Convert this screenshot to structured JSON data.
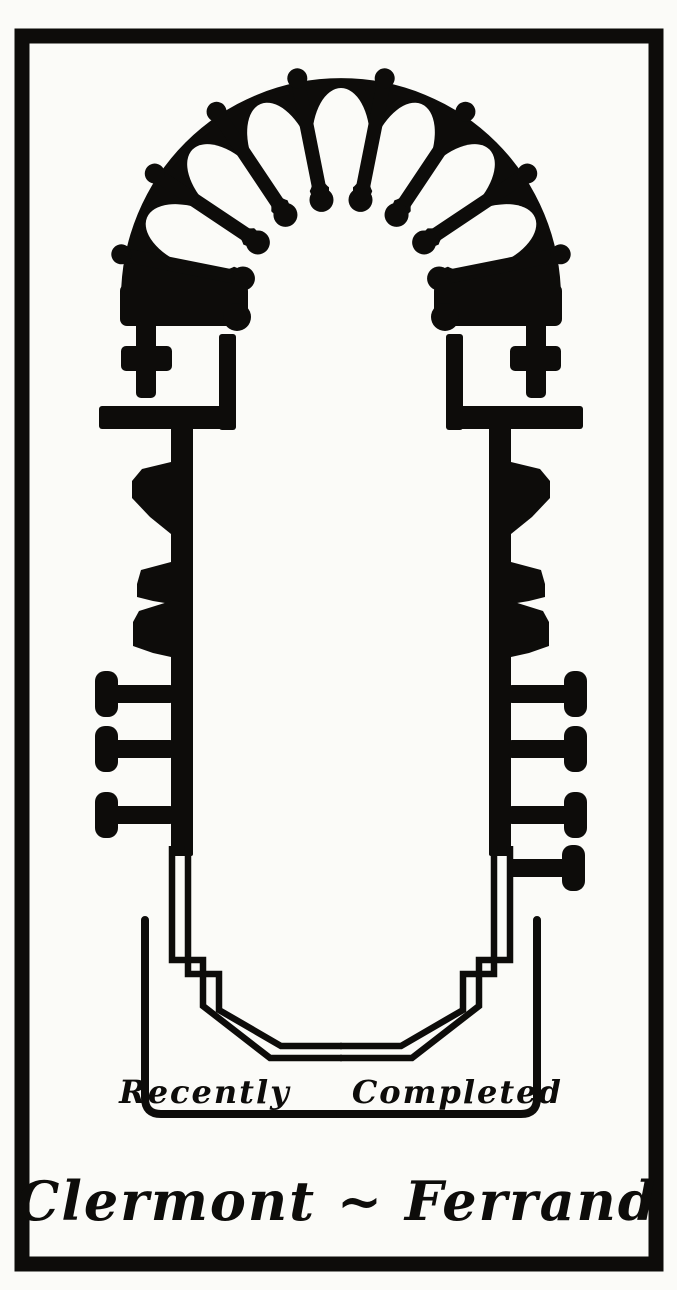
{
  "plan": {
    "annotation": "Recently Completed",
    "caption": "Clermont ~ Ferrand"
  },
  "colors": {
    "ink": "#0d0c0a",
    "paper": "#fbfbf8"
  }
}
